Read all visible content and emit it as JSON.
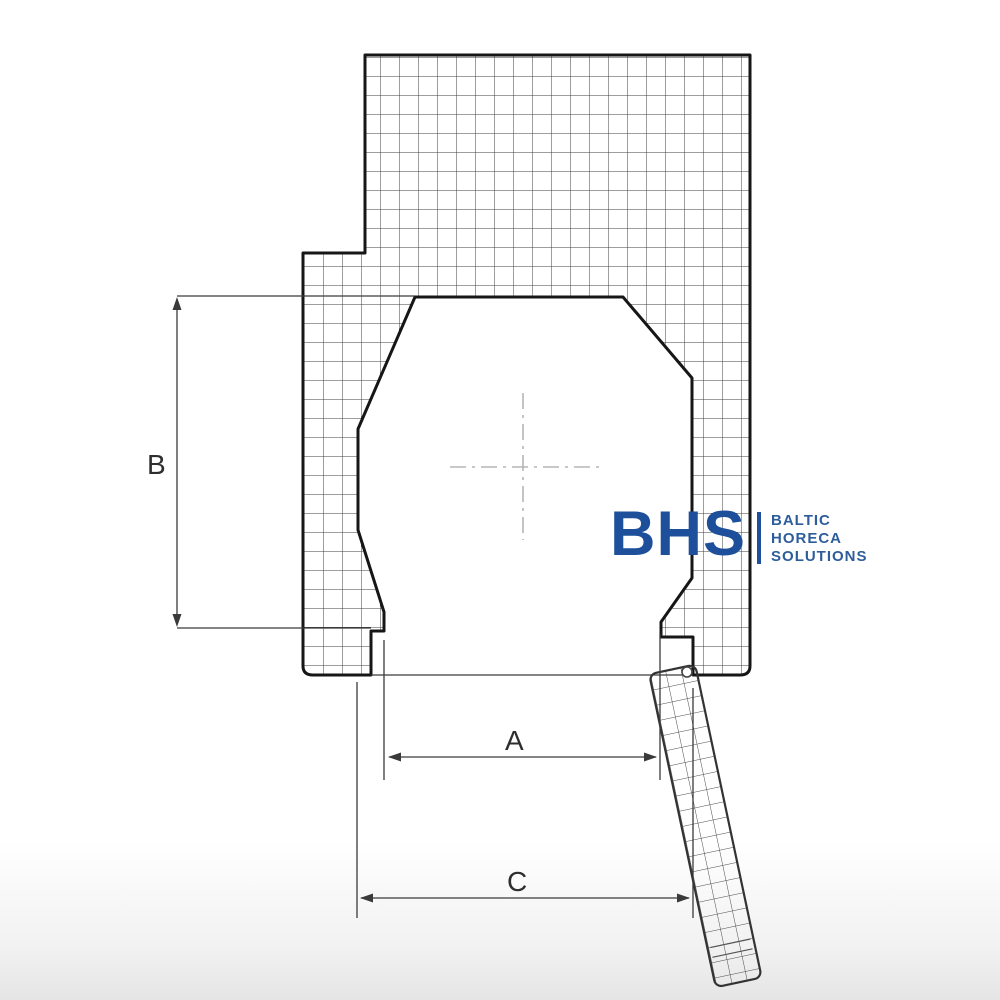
{
  "drawing": {
    "description": "technical-dimension-drawing",
    "labels": {
      "a": "A",
      "b": "B",
      "c": "C"
    },
    "colors": {
      "outline": "#161616",
      "hatch_grid": "#3d3d3d",
      "dimension_lines": "#3a3a3a",
      "centerline": "#b5b5b5"
    }
  },
  "logo": {
    "brand": "BHS",
    "line1": "BALTIC",
    "line2": "HORECA",
    "line3": "SOLUTIONS",
    "brand_color": "#1d4f9a",
    "text_color": "#2e5d9b"
  }
}
